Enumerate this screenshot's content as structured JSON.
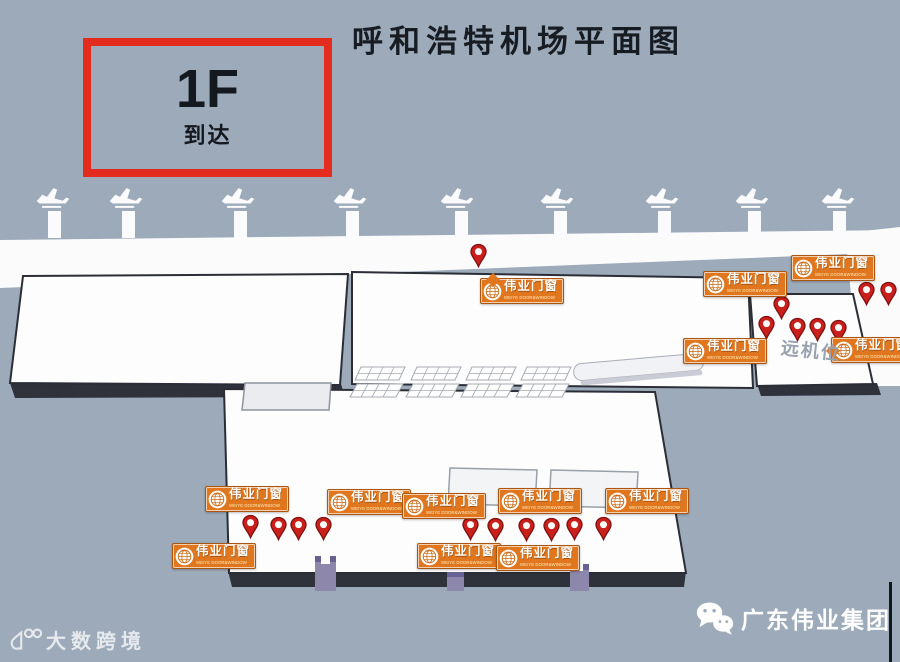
{
  "title": "呼和浩特机场平面图",
  "floor_box": {
    "floor": "1F",
    "label": "到达"
  },
  "brand_banner": {
    "cn": "伟业门窗",
    "en": "WEIYE DOOR&WINDOW",
    "logo": "WEIYE"
  },
  "labels": {
    "remote_stands": "远机位"
  },
  "watermark": {
    "text": "大数跨境"
  },
  "footer": {
    "brand": "广东伟业集团"
  },
  "colors": {
    "background": "#9caaba",
    "banner_orange": "#e0771e",
    "pin_red": "#c9201c",
    "box_red": "#e32b1e",
    "building_white": "#fdfdfe",
    "base_dark": "#2f313b"
  },
  "map": {
    "planes_x": [
      53,
      126,
      238,
      350,
      457,
      557,
      662,
      752,
      838
    ],
    "bridges_x": [
      54,
      128,
      240,
      352,
      461,
      560,
      664,
      754,
      839
    ],
    "pins": [
      [
        478,
        243
      ],
      [
        866,
        281
      ],
      [
        888,
        281
      ],
      [
        781,
        295
      ],
      [
        766,
        315
      ],
      [
        797,
        317
      ],
      [
        817,
        317
      ],
      [
        838,
        319
      ],
      [
        250,
        514
      ],
      [
        278,
        516
      ],
      [
        298,
        516
      ],
      [
        323,
        516
      ],
      [
        470,
        516
      ],
      [
        495,
        517
      ],
      [
        526,
        517
      ],
      [
        551,
        517
      ],
      [
        574,
        516
      ],
      [
        603,
        516
      ]
    ],
    "banners": [
      {
        "x": 480,
        "y": 278,
        "pointer": "top"
      },
      {
        "x": 791,
        "y": 255
      },
      {
        "x": 703,
        "y": 271
      },
      {
        "x": 683,
        "y": 338
      },
      {
        "x": 831,
        "y": 337,
        "pointer": "left"
      },
      {
        "x": 205,
        "y": 486
      },
      {
        "x": 327,
        "y": 489
      },
      {
        "x": 402,
        "y": 493
      },
      {
        "x": 498,
        "y": 488
      },
      {
        "x": 605,
        "y": 488
      },
      {
        "x": 172,
        "y": 543
      },
      {
        "x": 417,
        "y": 543
      },
      {
        "x": 496,
        "y": 545
      }
    ]
  }
}
